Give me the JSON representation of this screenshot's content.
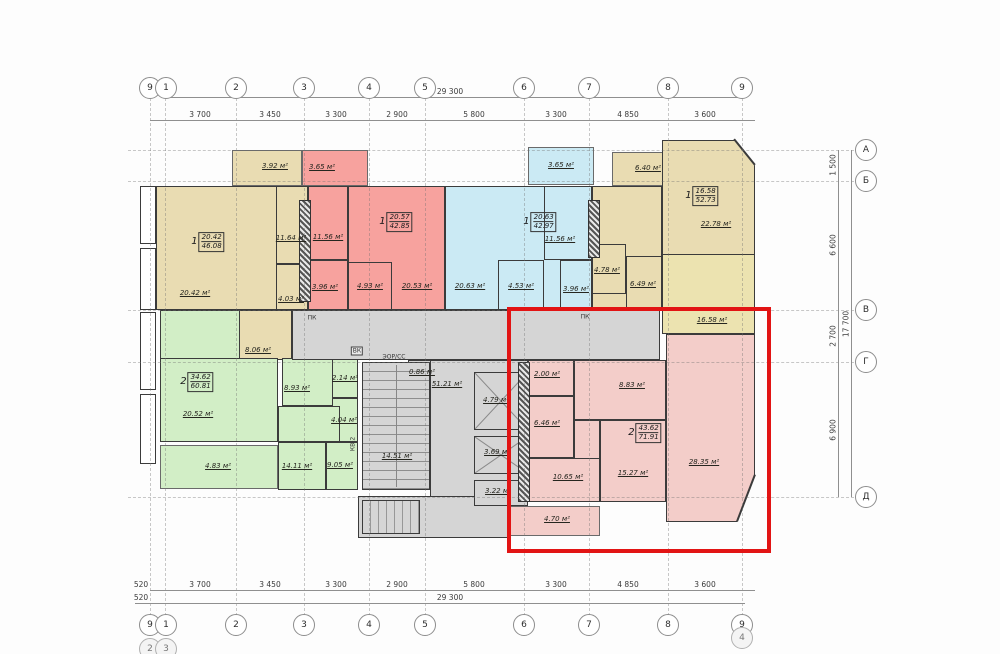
{
  "axes": {
    "numbers": [
      "9",
      "1",
      "2",
      "3",
      "4",
      "5",
      "6",
      "7",
      "8",
      "9"
    ],
    "bottom_extra": [
      "2",
      "3",
      "4"
    ],
    "letters": [
      "А",
      "Б",
      "В",
      "Г",
      "Д"
    ]
  },
  "dimensions": {
    "h_overall": "29 300",
    "h_segments": [
      "3 700",
      "3 450",
      "3 300",
      "2 900",
      "5 800",
      "3 300",
      "4 850",
      "3 600"
    ],
    "v_overall": "17 700",
    "v_segments": [
      "1 500",
      "6 600",
      "2 700",
      "6 900"
    ],
    "left_small": [
      "520",
      "520"
    ]
  },
  "apartments": {
    "apt1": {
      "num": "1",
      "living": "20.42",
      "total": "46.08"
    },
    "apt2": {
      "num": "1",
      "living": "20.57",
      "total": "42.85"
    },
    "apt3": {
      "num": "1",
      "living": "20.63",
      "total": "42.97"
    },
    "apt4": {
      "num": "1",
      "living": "16.58",
      "total": "52.73"
    },
    "apt5": {
      "num": "2",
      "living": "34.62",
      "total": "60.81"
    },
    "apt6": {
      "num": "2",
      "living": "43.62",
      "total": "71.91"
    }
  },
  "rooms": {
    "balc_392": "3.92 м²",
    "balc_365_red": "3.65 м²",
    "balc_365_cyan": "3.65 м²",
    "balc_640": "6.40 м²",
    "a1_living": "20.42 м²",
    "a1_kitchen": "11.64 м²",
    "a1_bath": "4.03 м²",
    "a1_room8": "8.06 м²",
    "a2_kitchen": "11.56 м²",
    "a2_bath": "3.96 м²",
    "a2_room": "20.53 м²",
    "a2_hall": "4.93 м²",
    "a3_room": "20.63 м²",
    "a3_kitchen": "11.56 м²",
    "a3_hall": "4.53 м²",
    "a3_bath": "3.96 м²",
    "a4_bath": "4.78 м²",
    "a4_hall": "6.49 м²",
    "a4_room_big": "22.78 м²",
    "a4_bedroom": "16.58 м²",
    "g_room": "20.52 м²",
    "g_balcony": "4.83 м²",
    "g_hall": "8.93 м²",
    "g_wc": "2.14 м²",
    "g_bath": "4.04 м²",
    "g_bed": "14.11 м²",
    "g_kitchen": "9.05 м²",
    "core_lobby": "0.86 м²",
    "core_corridor": "51.21 м²",
    "core_stairs": "14.51 м²",
    "core_elev1": "4.79 м²",
    "core_elev2": "3.69 м²",
    "core_room": "3.22 м²",
    "p_wc": "2.00 м²",
    "p_bath": "6.46 м²",
    "p_hall": "8.83 м²",
    "p_kitchen": "10.65 м²",
    "p_bedroom": "15.27 м²",
    "p_living": "28.35 м²",
    "p_balcony": "4.70 м²"
  },
  "annotations": {
    "pk1": "ПК",
    "pk2": "ПК",
    "vk": "ВК",
    "eor": "ЭОР/СС",
    "kv2": "КВ-2"
  },
  "colors": {
    "highlight": "#e21414",
    "beige": "#e9dcb2",
    "red": "#f7a29e",
    "cyan": "#cbeaf4",
    "green": "#d2eec6",
    "gray": "#d5d5d5",
    "pink": "#f3cdc9"
  }
}
